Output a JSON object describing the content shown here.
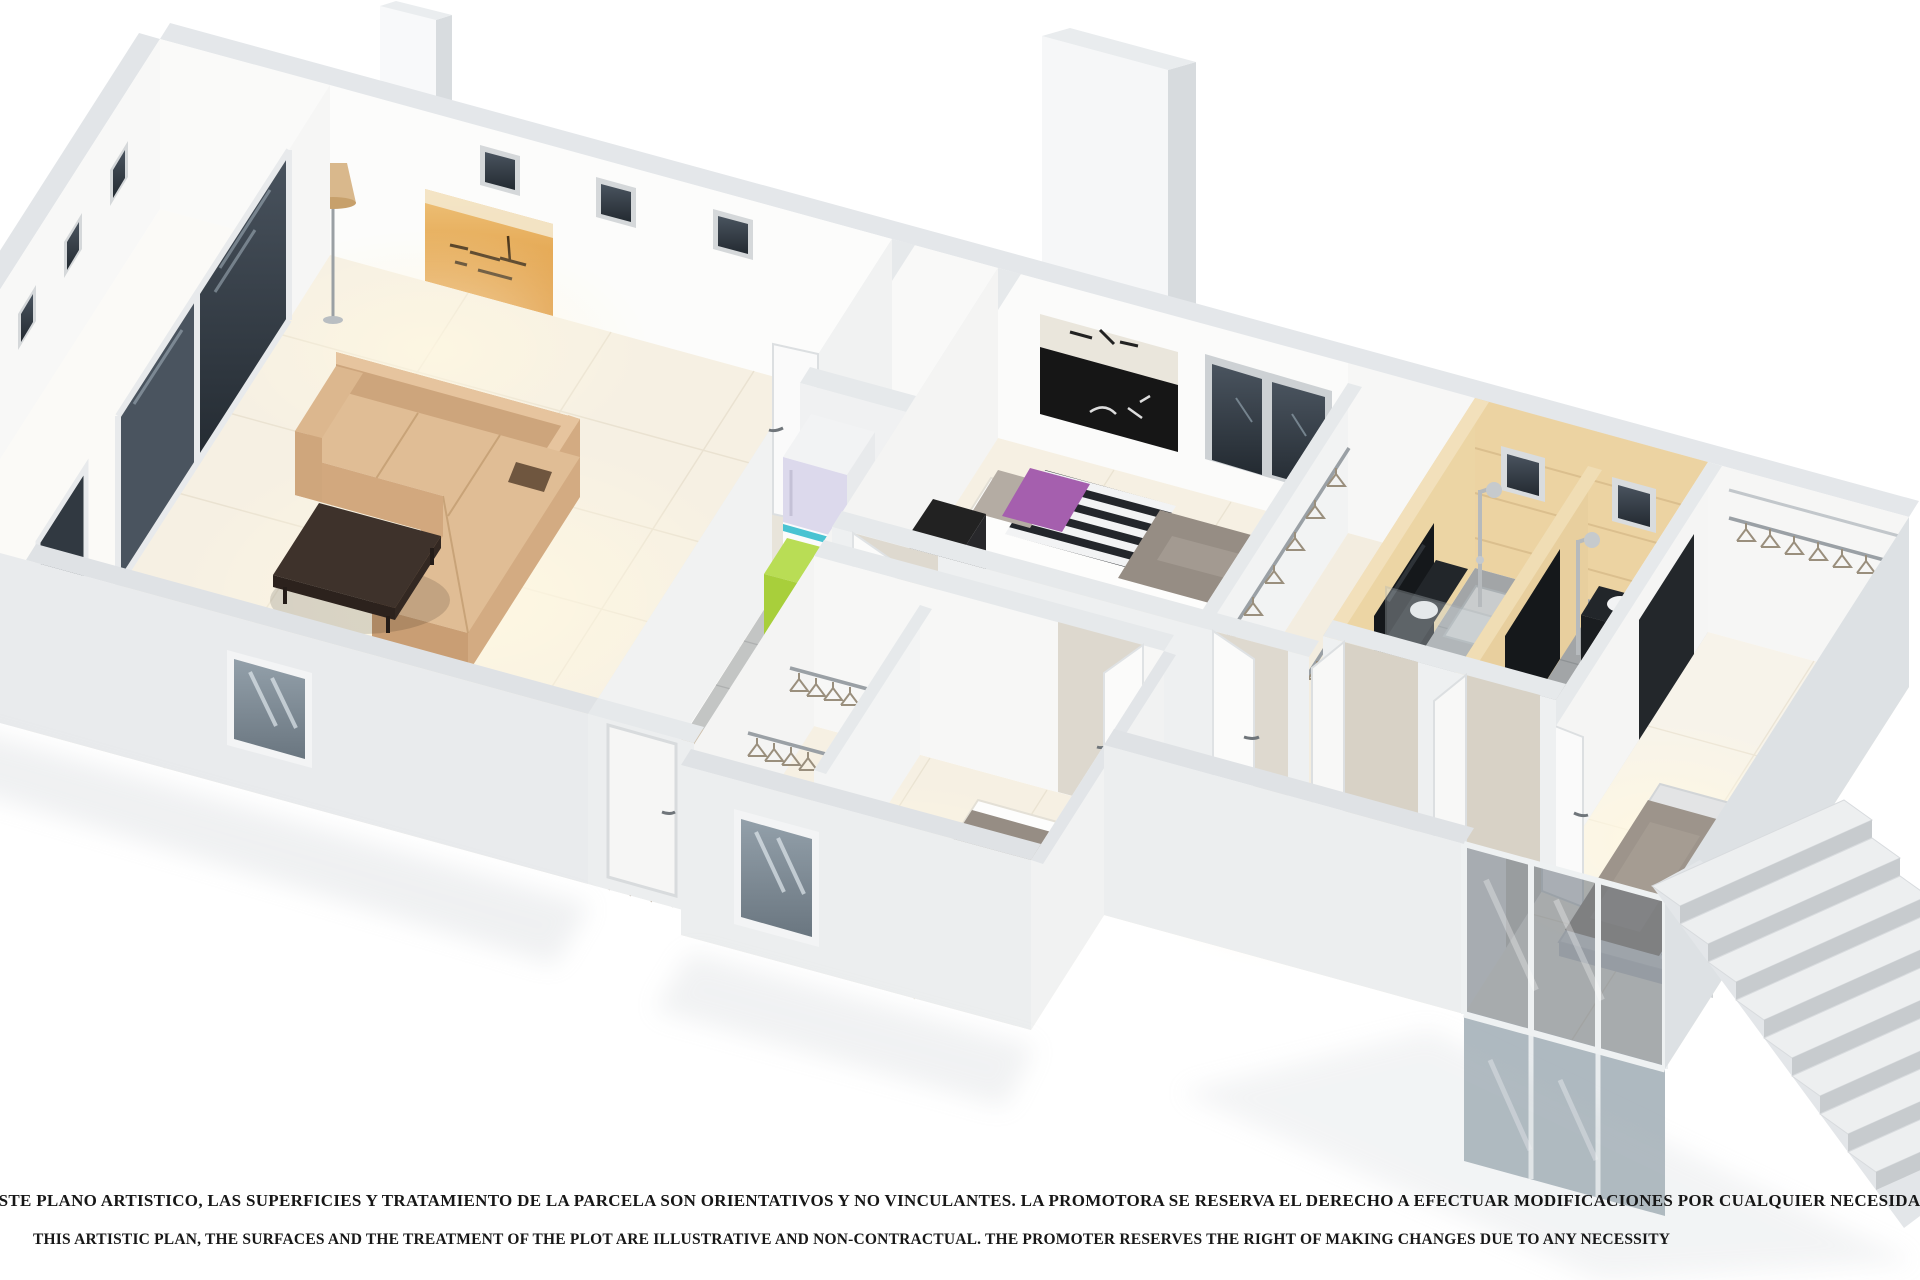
{
  "image": {
    "kind": "3d-isometric-floor-plan-rendering",
    "style": "cutaway dollhouse view, white walls, cream tiled floors, no room labels"
  },
  "disclaimer": {
    "line_es": "ESTE PLANO ARTISTICO, LAS SUPERFICIES Y TRATAMIENTO DE LA PARCELA SON ORIENTATIVOS Y NO VINCULANTES. LA PROMOTORA SE RESERVA EL DERECHO A EFECTUAR MODIFICACIONES POR CUALQUIER NECESIDAD",
    "line_en": "THIS ARTISTIC PLAN, THE SURFACES AND THE TREATMENT OF THE PLOT ARE ILLUSTRATIVE AND NON-CONTRACTUAL. THE PROMOTER RESERVES THE RIGHT OF MAKING CHANGES DUE TO ANY NECESSITY"
  },
  "palette": {
    "wall_white": "#fbfbfa",
    "wall_top_band": "#e4e7ea",
    "wall_shade": "#dde1e4",
    "floor_cream": "#f6f0e3",
    "bath_beige": "#ecd3a2",
    "bath_floor_gray": "#a2a5a7",
    "kitchen_tile_gray": "#c3c5c4",
    "corridor_wood": "#cfc0ab",
    "sofa_tan": "#d8b48c",
    "coffee_table_brown": "#3e322b",
    "duvet_gray": "#968d84",
    "pillow_purple": "#a55fae",
    "pillow_orange": "#e8a62e",
    "fridge_accent_green": "#a8cf3b",
    "fridge_accent_teal": "#49c3d2",
    "art_orange": "#e09a42",
    "window_glass_dark": "#39424b"
  },
  "rooms": [
    {
      "id": "terrace",
      "furnishings": [
        "sliding-glass-doors",
        "dark-glass-door"
      ]
    },
    {
      "id": "living-room",
      "furnishings": [
        "corner-sofa",
        "coffee-table",
        "floor-lamp",
        "orange-wall-art",
        "pouf",
        "front-window"
      ]
    },
    {
      "id": "kitchen",
      "furnishings": [
        "fridge-freezer",
        "green-cabinet",
        "gray-tile-floor"
      ]
    },
    {
      "id": "corridor",
      "furnishings": [
        "wood-floor",
        "doormat",
        "entry-door"
      ]
    },
    {
      "id": "bedroom-1",
      "furnishings": [
        "single-bed",
        "single-bed",
        "black-desk",
        "black-white-wall-art",
        "double-window",
        "purple-pillows"
      ]
    },
    {
      "id": "walk-in-closet",
      "furnishings": [
        "clothes-rails",
        "hangers"
      ]
    },
    {
      "id": "bathroom",
      "furnishings": [
        "shower-column",
        "dark-vanity",
        "sink",
        "toilet",
        "beige-wall-tiles",
        "small-windows"
      ]
    },
    {
      "id": "ensuite-bathroom",
      "furnishings": [
        "shower-head",
        "dark-vanity",
        "sink",
        "toilet"
      ]
    },
    {
      "id": "master-bedroom",
      "furnishings": [
        "double-bed",
        "chevron-sheets",
        "closet-rail",
        "tv-panel",
        "glazed-wall"
      ]
    },
    {
      "id": "bedroom-2",
      "furnishings": [
        "single-bed",
        "single-bed",
        "closet-rails",
        "orange-pillows",
        "front-window"
      ]
    },
    {
      "id": "exterior-staircase",
      "furnishings": [
        "steps"
      ]
    }
  ]
}
